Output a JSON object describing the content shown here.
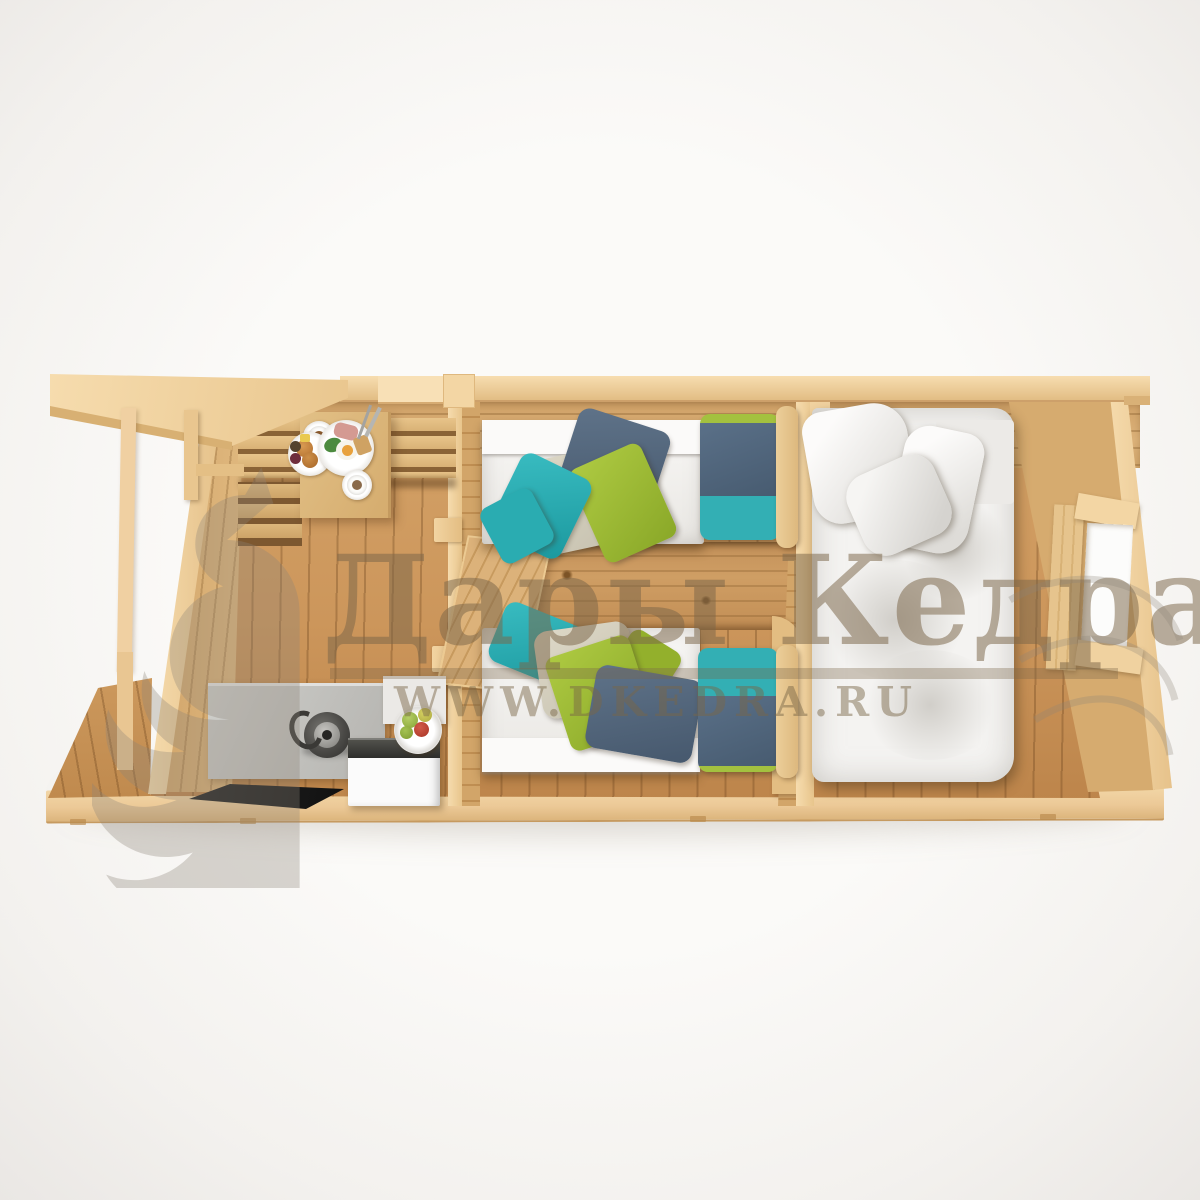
{
  "watermark": {
    "brand": "Дары Кедра",
    "url": "WWW.DKEDRA.RU",
    "logo_icon": "squirrel-logo",
    "color": "#7a6748"
  },
  "scene": {
    "type": "3d-top-down-render",
    "subject": "wooden log cabin interior floor plan",
    "objects": [
      "porch-roof-overhang",
      "porch-deck",
      "porch-post",
      "corner-bench",
      "dining-table",
      "breakfast-set",
      "kitchen-counter",
      "kettle",
      "mini-fridge",
      "fruit-bowl",
      "floor-mat",
      "interior-door",
      "single-bed-top",
      "single-bed-bottom",
      "twin-pillows",
      "double-bed",
      "double-bed-pillows",
      "window-opening",
      "log-walls",
      "plank-floor",
      "base-platform"
    ],
    "palette": {
      "background": "#f7f5f3",
      "wood_cut_top": "#f3d6a3",
      "wood_wall": "#d6ac72",
      "wood_floor": "#c9945a",
      "mattress_white": "#f1efec",
      "duvet_white": "#f4f3f1",
      "textile_teal": "#2fb3b8",
      "textile_green": "#a6c437",
      "textile_beige": "#d9d4c3",
      "textile_navy": "#51677e",
      "counter_gray": "#c2c1bd",
      "appliance_white": "#fbfbfb",
      "appliance_top_black": "#3b3b3b",
      "mat_black": "#1c1c1c"
    }
  }
}
